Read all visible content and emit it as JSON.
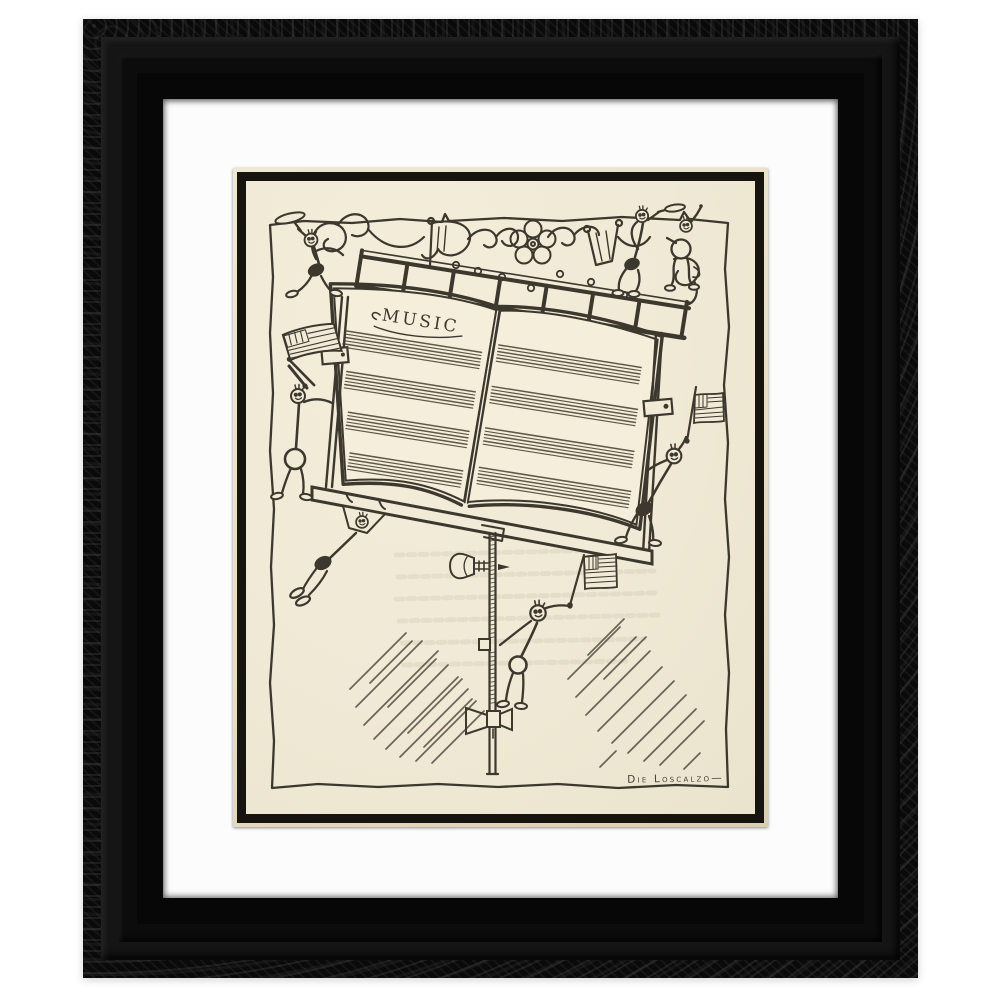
{
  "scene": {
    "type": "framed-art-print-photo",
    "background_color": "#ffffff"
  },
  "frame": {
    "style": "ornate carved black wood",
    "color": "#0a0a0a",
    "mat_color": "#fcfcfc",
    "opening_bevel_color": "#e9e1c8",
    "print_border_color": "#17130e"
  },
  "artwork": {
    "style": "vintage pen-and-ink cartoon print",
    "subject": "Cartoon music-note stick figures climbing a music stand holding an open book of blank staves, waving American flags, with a scrolled ornament band on top",
    "book_title": "MUSIC",
    "signature": "Die Loscalzo—",
    "colors": {
      "paper": "#f1ead7",
      "ink": "#3d382e",
      "staff": "#57513f",
      "ghost": "#8d8468"
    },
    "staff": {
      "lines_per_group": 6,
      "line_spacing": 3.3,
      "line_width": 1.15,
      "left_groups": [
        {
          "y": 152,
          "x1": 108,
          "x2": 246
        },
        {
          "y": 192,
          "x1": 116,
          "x2": 246
        },
        {
          "y": 232,
          "x1": 124,
          "x2": 246
        },
        {
          "y": 272,
          "x1": 132,
          "x2": 246
        }
      ],
      "right_groups": [
        {
          "y": 142,
          "x1": 262,
          "x2": 406
        },
        {
          "y": 184,
          "x1": 262,
          "x2": 409
        },
        {
          "y": 226,
          "x1": 262,
          "x2": 412
        },
        {
          "y": 266,
          "x1": 262,
          "x2": 415
        }
      ]
    },
    "pole_threads": {
      "x1": 243.5,
      "x2": 249.5,
      "step": 4.2,
      "ranges": [
        [
          356,
          458
        ],
        [
          472,
          524
        ]
      ]
    },
    "hatch_left": [
      [
        104,
        508,
        160,
        452
      ],
      [
        110,
        526,
        176,
        460
      ],
      [
        118,
        544,
        192,
        470
      ],
      [
        128,
        558,
        202,
        484
      ],
      [
        140,
        568,
        212,
        496
      ],
      [
        154,
        576,
        222,
        508
      ],
      [
        170,
        580,
        230,
        520
      ],
      [
        186,
        582,
        238,
        530
      ],
      [
        124,
        502,
        166,
        460
      ],
      [
        142,
        526,
        190,
        478
      ],
      [
        162,
        552,
        216,
        498
      ],
      [
        178,
        566,
        226,
        518
      ]
    ],
    "hatch_right": [
      [
        322,
        498,
        374,
        446
      ],
      [
        330,
        516,
        390,
        456
      ],
      [
        340,
        534,
        404,
        470
      ],
      [
        352,
        550,
        416,
        486
      ],
      [
        366,
        562,
        428,
        500
      ],
      [
        382,
        572,
        440,
        514
      ],
      [
        398,
        580,
        450,
        528
      ],
      [
        414,
        584,
        458,
        540
      ],
      [
        342,
        474,
        378,
        438
      ],
      [
        358,
        498,
        400,
        456
      ],
      [
        354,
        586,
        370,
        570
      ],
      [
        438,
        588,
        454,
        572
      ]
    ],
    "ghost_lines": [
      [
        150,
        374,
        402,
        368
      ],
      [
        152,
        396,
        408,
        390
      ],
      [
        150,
        418,
        410,
        412
      ],
      [
        153,
        440,
        412,
        434
      ],
      [
        156,
        462,
        398,
        458
      ],
      [
        158,
        484,
        380,
        480
      ]
    ]
  }
}
